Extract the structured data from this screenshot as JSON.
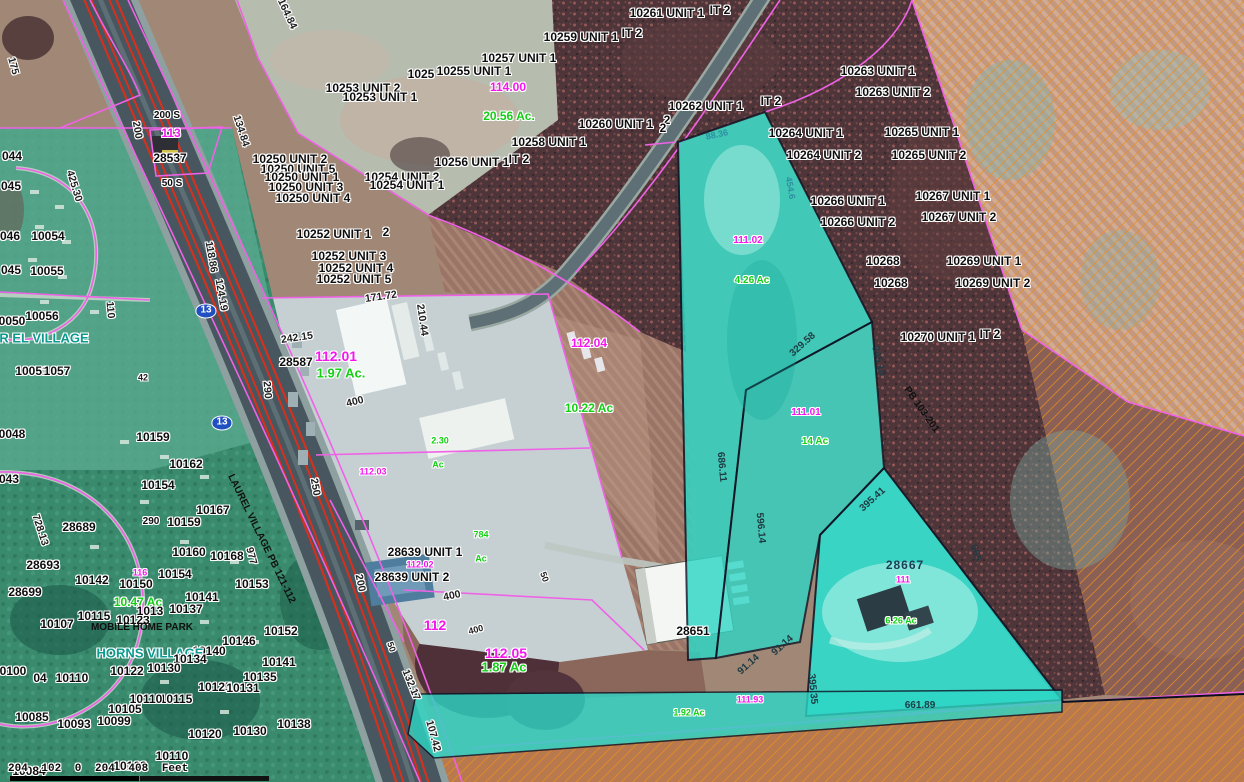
{
  "map": {
    "scalebar_text": "204 102 0 204 408 Feet",
    "route_shield": "13",
    "place_names": [
      "LAUREL VILLAGE",
      "HORNS VILLAGE",
      "MOBILE HOME PARK",
      "LAUREL VILLAGE PB 121-112"
    ],
    "colors": {
      "highlight_cyan": "#2ed7c6",
      "parcel_line_magenta": "#ef62e6",
      "hatch_orange": "#ea8f1c",
      "route_shield_blue": "#2050c0",
      "acreage_green": "#14cf14",
      "map_number_magenta": "#f715ef"
    }
  },
  "labels": [
    {
      "t": "10261 UNIT 1",
      "x": 667,
      "y": 13
    },
    {
      "t": "IT 2",
      "x": 720,
      "y": 10
    },
    {
      "t": "10259 UNIT 1",
      "x": 581,
      "y": 37
    },
    {
      "t": "IT 2",
      "x": 632,
      "y": 33
    },
    {
      "t": "10257 UNIT 1",
      "x": 519,
      "y": 58
    },
    {
      "t": "1025",
      "x": 421,
      "y": 74
    },
    {
      "t": "10255 UNIT 1",
      "x": 474,
      "y": 71
    },
    {
      "t": "10253 UNIT 2",
      "x": 363,
      "y": 88
    },
    {
      "t": "10253 UNIT 1",
      "x": 380,
      "y": 97
    },
    {
      "t": "114.00",
      "x": 508,
      "y": 87,
      "s": "mag"
    },
    {
      "t": "20.56 Ac.",
      "x": 509,
      "y": 116,
      "s": "grn"
    },
    {
      "t": "10250 UNIT 2",
      "x": 290,
      "y": 159
    },
    {
      "t": "10250 UNIT 5",
      "x": 298,
      "y": 169
    },
    {
      "t": "10250 UNIT 1",
      "x": 302,
      "y": 177
    },
    {
      "t": "10250 UNIT 3",
      "x": 306,
      "y": 187
    },
    {
      "t": "10250 UNIT 4",
      "x": 313,
      "y": 198
    },
    {
      "t": "10254 UNIT 2",
      "x": 402,
      "y": 177
    },
    {
      "t": "10254 UNIT 1",
      "x": 407,
      "y": 185
    },
    {
      "t": "10256 UNIT 1",
      "x": 472,
      "y": 162
    },
    {
      "t": "IT 2",
      "x": 519,
      "y": 159
    },
    {
      "t": "10258 UNIT 1",
      "x": 549,
      "y": 142
    },
    {
      "t": "10260 UNIT 1",
      "x": 616,
      "y": 124
    },
    {
      "t": "2",
      "x": 667,
      "y": 120
    },
    {
      "t": "10262 UNIT 1",
      "x": 706,
      "y": 106
    },
    {
      "t": "IT 2",
      "x": 771,
      "y": 101
    },
    {
      "t": "2",
      "x": 663,
      "y": 128
    },
    {
      "t": "10252 UNIT 1",
      "x": 334,
      "y": 234
    },
    {
      "t": "2",
      "x": 386,
      "y": 232
    },
    {
      "t": "10252 UNIT 3",
      "x": 349,
      "y": 256
    },
    {
      "t": "10252 UNIT 4",
      "x": 356,
      "y": 268
    },
    {
      "t": "10252 UNIT 5",
      "x": 354,
      "y": 279
    },
    {
      "t": "134.84",
      "x": 241,
      "y": 131,
      "s": "dim",
      "r": 72
    },
    {
      "t": "164.84",
      "x": 287,
      "y": 14,
      "s": "dim",
      "r": 65
    },
    {
      "t": "175",
      "x": 13,
      "y": 66,
      "s": "dim",
      "r": 75
    },
    {
      "t": "200 S",
      "x": 167,
      "y": 116,
      "s": "parcel-sm"
    },
    {
      "t": "200",
      "x": 137,
      "y": 130,
      "s": "dim",
      "r": 80
    },
    {
      "t": "113",
      "x": 171,
      "y": 133,
      "s": "mag"
    },
    {
      "t": "28537",
      "x": 170,
      "y": 158
    },
    {
      "t": "50 S",
      "x": 172,
      "y": 184,
      "s": "parcel-sm"
    },
    {
      "t": "425.30",
      "x": 74,
      "y": 186,
      "s": "dim",
      "r": 73
    },
    {
      "t": "118.86",
      "x": 211,
      "y": 257,
      "s": "dim",
      "r": 80
    },
    {
      "t": "124.19",
      "x": 221,
      "y": 295,
      "s": "dim",
      "r": 80
    },
    {
      "t": "110",
      "x": 110,
      "y": 310,
      "s": "dim",
      "r": 85
    },
    {
      "t": "13",
      "x": 206,
      "y": 311,
      "s": "shield"
    },
    {
      "t": "13",
      "x": 222,
      "y": 423,
      "s": "shield"
    },
    {
      "t": "242.15",
      "x": 297,
      "y": 338,
      "s": "dim",
      "r": -8
    },
    {
      "t": "28587",
      "x": 296,
      "y": 362
    },
    {
      "t": "112.01",
      "x": 336,
      "y": 356,
      "s": "mag",
      "f": 14
    },
    {
      "t": "1.97 Ac.",
      "x": 341,
      "y": 373,
      "s": "grn",
      "f": 13
    },
    {
      "t": "171.72",
      "x": 381,
      "y": 297,
      "s": "dim",
      "r": -8
    },
    {
      "t": "210.44",
      "x": 422,
      "y": 320,
      "s": "dim",
      "r": 82
    },
    {
      "t": "290",
      "x": 267,
      "y": 390,
      "s": "dim",
      "r": 85
    },
    {
      "t": "400",
      "x": 355,
      "y": 402,
      "s": "dim",
      "r": -14
    },
    {
      "t": "2.30",
      "x": 440,
      "y": 441,
      "s": "grn-sm"
    },
    {
      "t": "112.03",
      "x": 373,
      "y": 472,
      "s": "mag-sm"
    },
    {
      "t": "Ac",
      "x": 438,
      "y": 465,
      "s": "grn-sm"
    },
    {
      "t": "250",
      "x": 315,
      "y": 487,
      "s": "dim",
      "r": 80
    },
    {
      "t": "290",
      "x": 151,
      "y": 522,
      "s": "parcel-sm"
    },
    {
      "t": "728.13",
      "x": 40,
      "y": 530,
      "s": "dim",
      "r": 72
    },
    {
      "t": "42",
      "x": 143,
      "y": 378,
      "s": "dim-sm"
    },
    {
      "t": "LAUREL VILLAGE PB 121-112",
      "x": 261,
      "y": 539,
      "s": "plain",
      "r": 64
    },
    {
      "t": "977",
      "x": 251,
      "y": 556,
      "s": "dim",
      "r": 75
    },
    {
      "t": "112.04",
      "x": 589,
      "y": 343,
      "s": "mag"
    },
    {
      "t": "10.22 Ac",
      "x": 589,
      "y": 408,
      "s": "grn"
    },
    {
      "t": "044",
      "x": 12,
      "y": 156
    },
    {
      "t": "045",
      "x": 11,
      "y": 186
    },
    {
      "t": "046",
      "x": 10,
      "y": 236
    },
    {
      "t": "10054",
      "x": 48,
      "y": 236
    },
    {
      "t": "045",
      "x": 11,
      "y": 270
    },
    {
      "t": "10055",
      "x": 47,
      "y": 271
    },
    {
      "t": "0050",
      "x": 12,
      "y": 321
    },
    {
      "t": "10056",
      "x": 42,
      "y": 316
    },
    {
      "t": "R EL VILLAGE",
      "x": 44,
      "y": 338,
      "s": "teal"
    },
    {
      "t": "10051",
      "x": 32,
      "y": 371
    },
    {
      "t": "1057",
      "x": 57,
      "y": 371
    },
    {
      "t": "0048",
      "x": 12,
      "y": 434
    },
    {
      "t": "043",
      "x": 9,
      "y": 479
    },
    {
      "t": "10159",
      "x": 153,
      "y": 437
    },
    {
      "t": "10162",
      "x": 186,
      "y": 464
    },
    {
      "t": "10154",
      "x": 158,
      "y": 485
    },
    {
      "t": "10167",
      "x": 213,
      "y": 510
    },
    {
      "t": "10159",
      "x": 184,
      "y": 522
    },
    {
      "t": "28689",
      "x": 79,
      "y": 527
    },
    {
      "t": "10160",
      "x": 189,
      "y": 552
    },
    {
      "t": "10168",
      "x": 227,
      "y": 556
    },
    {
      "t": "28693",
      "x": 43,
      "y": 565
    },
    {
      "t": "10154",
      "x": 175,
      "y": 574
    },
    {
      "t": "116",
      "x": 140,
      "y": 573,
      "s": "mag-sm"
    },
    {
      "t": "10142",
      "x": 92,
      "y": 580
    },
    {
      "t": "10150",
      "x": 136,
      "y": 584
    },
    {
      "t": "10153",
      "x": 252,
      "y": 584
    },
    {
      "t": "28699",
      "x": 25,
      "y": 592
    },
    {
      "t": "10.47 Ac",
      "x": 138,
      "y": 602,
      "s": "grn"
    },
    {
      "t": "10141",
      "x": 202,
      "y": 597
    },
    {
      "t": "10115",
      "x": 94,
      "y": 616
    },
    {
      "t": "10123",
      "x": 133,
      "y": 620
    },
    {
      "t": "1013",
      "x": 150,
      "y": 611
    },
    {
      "t": "10137",
      "x": 186,
      "y": 609
    },
    {
      "t": "MOBILE HOME PARK",
      "x": 142,
      "y": 628,
      "s": "plain"
    },
    {
      "t": "10107",
      "x": 57,
      "y": 624
    },
    {
      "t": "10152",
      "x": 281,
      "y": 631
    },
    {
      "t": "10146",
      "x": 239,
      "y": 641
    },
    {
      "t": "10140",
      "x": 209,
      "y": 651
    },
    {
      "t": "HORNS VILLAGE",
      "x": 150,
      "y": 653,
      "s": "teal"
    },
    {
      "t": "10134",
      "x": 190,
      "y": 659
    },
    {
      "t": "10141",
      "x": 279,
      "y": 662
    },
    {
      "t": "10122",
      "x": 127,
      "y": 671
    },
    {
      "t": "10130",
      "x": 164,
      "y": 668
    },
    {
      "t": "0100",
      "x": 13,
      "y": 671
    },
    {
      "t": "04",
      "x": 40,
      "y": 678
    },
    {
      "t": "10110",
      "x": 72,
      "y": 678
    },
    {
      "t": "10135",
      "x": 260,
      "y": 677
    },
    {
      "t": "10125",
      "x": 215,
      "y": 687
    },
    {
      "t": "10131",
      "x": 243,
      "y": 688
    },
    {
      "t": "10115",
      "x": 176,
      "y": 699
    },
    {
      "t": "10110",
      "x": 146,
      "y": 699
    },
    {
      "t": "10105",
      "x": 125,
      "y": 709
    },
    {
      "t": "10085",
      "x": 32,
      "y": 717
    },
    {
      "t": "10093",
      "x": 74,
      "y": 724
    },
    {
      "t": "10099",
      "x": 114,
      "y": 721
    },
    {
      "t": "10120",
      "x": 205,
      "y": 734
    },
    {
      "t": "10130",
      "x": 250,
      "y": 731
    },
    {
      "t": "10138",
      "x": 294,
      "y": 724
    },
    {
      "t": "10110",
      "x": 172,
      "y": 756
    },
    {
      "t": "10102",
      "x": 130,
      "y": 766
    },
    {
      "t": "10084",
      "x": 29,
      "y": 771
    },
    {
      "t": "28639 UNIT 1",
      "x": 425,
      "y": 552
    },
    {
      "t": "112.02",
      "x": 420,
      "y": 565,
      "s": "mag-sm"
    },
    {
      "t": "28639 UNIT 2",
      "x": 412,
      "y": 577
    },
    {
      "t": "200",
      "x": 360,
      "y": 583,
      "s": "dim",
      "r": 78
    },
    {
      "t": "784",
      "x": 481,
      "y": 535,
      "s": "grn-sm"
    },
    {
      "t": "Ac",
      "x": 481,
      "y": 559,
      "s": "grn-sm"
    },
    {
      "t": "400",
      "x": 452,
      "y": 596,
      "s": "dim",
      "r": -12
    },
    {
      "t": "50",
      "x": 544,
      "y": 577,
      "s": "dim-sm",
      "r": 70
    },
    {
      "t": "112",
      "x": 435,
      "y": 625,
      "s": "mag",
      "f": 14
    },
    {
      "t": "400",
      "x": 476,
      "y": 630,
      "s": "dim-sm",
      "r": -15
    },
    {
      "t": "50",
      "x": 391,
      "y": 647,
      "s": "dim-sm",
      "r": 70
    },
    {
      "t": "112.05",
      "x": 506,
      "y": 653,
      "s": "mag",
      "f": 14
    },
    {
      "t": "1.87 Ac",
      "x": 504,
      "y": 667,
      "s": "grn",
      "f": 13
    },
    {
      "t": "132.17",
      "x": 411,
      "y": 685,
      "s": "dim",
      "r": 68
    },
    {
      "t": "107.42",
      "x": 433,
      "y": 736,
      "s": "dim",
      "r": 75
    },
    {
      "t": "28651",
      "x": 693,
      "y": 631
    },
    {
      "t": "91.14",
      "x": 749,
      "y": 665,
      "s": "dimc",
      "r": -42
    },
    {
      "t": "91.14",
      "x": 783,
      "y": 646,
      "s": "dimc",
      "r": -42
    },
    {
      "t": "111.93",
      "x": 750,
      "y": 700,
      "s": "mag-sm"
    },
    {
      "t": "1.92 Ac",
      "x": 689,
      "y": 713,
      "s": "grn-sm"
    },
    {
      "t": "395.35",
      "x": 812,
      "y": 689,
      "s": "dimc",
      "r": 85
    },
    {
      "t": "661.89",
      "x": 920,
      "y": 706,
      "s": "dimc"
    },
    {
      "t": "665",
      "x": 975,
      "y": 553,
      "s": "dimc",
      "r": 75
    },
    {
      "t": "395.41",
      "x": 873,
      "y": 500,
      "s": "dimc",
      "r": -42
    },
    {
      "t": "28667",
      "x": 905,
      "y": 565,
      "s": "navy"
    },
    {
      "t": "111",
      "x": 903,
      "y": 580,
      "s": "mag-sm"
    },
    {
      "t": "6.26 Ac",
      "x": 901,
      "y": 621,
      "s": "grn-sm"
    },
    {
      "t": "686.11",
      "x": 721,
      "y": 467,
      "s": "dimc",
      "r": 85
    },
    {
      "t": "596.14",
      "x": 760,
      "y": 528,
      "s": "dimc",
      "r": 85
    },
    {
      "t": "329.58",
      "x": 803,
      "y": 345,
      "s": "dimc",
      "r": -42
    },
    {
      "t": "345.15",
      "x": 878,
      "y": 361,
      "s": "dimc",
      "r": 75
    },
    {
      "t": "PB 103-201",
      "x": 921,
      "y": 410,
      "s": "plain",
      "r": 55
    },
    {
      "t": "88.36",
      "x": 717,
      "y": 135,
      "s": "cy",
      "r": -12
    },
    {
      "t": "454.6",
      "x": 790,
      "y": 188,
      "s": "cy",
      "r": 80
    },
    {
      "t": "111.02",
      "x": 748,
      "y": 241,
      "s": "mag-sm",
      "f": 10
    },
    {
      "t": "4.26 Ac",
      "x": 752,
      "y": 281,
      "s": "grn-sm",
      "f": 10
    },
    {
      "t": "111.01",
      "x": 806,
      "y": 413,
      "s": "mag-sm",
      "f": 10
    },
    {
      "t": "14 Ac",
      "x": 815,
      "y": 442,
      "s": "grn-sm",
      "f": 10
    },
    {
      "t": "10263 UNIT 1",
      "x": 878,
      "y": 71
    },
    {
      "t": "10263 UNIT 2",
      "x": 893,
      "y": 92
    },
    {
      "t": "10264 UNIT 1",
      "x": 806,
      "y": 133
    },
    {
      "t": "10264 UNIT 2",
      "x": 824,
      "y": 155
    },
    {
      "t": "10265 UNIT 1",
      "x": 922,
      "y": 132
    },
    {
      "t": "10265 UNIT 2",
      "x": 929,
      "y": 155
    },
    {
      "t": "10266 UNIT 1",
      "x": 848,
      "y": 201
    },
    {
      "t": "10266 UNIT 2",
      "x": 858,
      "y": 222
    },
    {
      "t": "10267 UNIT 1",
      "x": 953,
      "y": 196
    },
    {
      "t": "10267 UNIT 2",
      "x": 959,
      "y": 217
    },
    {
      "t": "10268",
      "x": 883,
      "y": 261
    },
    {
      "t": "10268",
      "x": 891,
      "y": 283
    },
    {
      "t": "10269 UNIT 1",
      "x": 984,
      "y": 261
    },
    {
      "t": "10269 UNIT 2",
      "x": 993,
      "y": 283
    },
    {
      "t": "10270 UNIT 1",
      "x": 938,
      "y": 337
    },
    {
      "t": "IT 2",
      "x": 990,
      "y": 334
    }
  ]
}
